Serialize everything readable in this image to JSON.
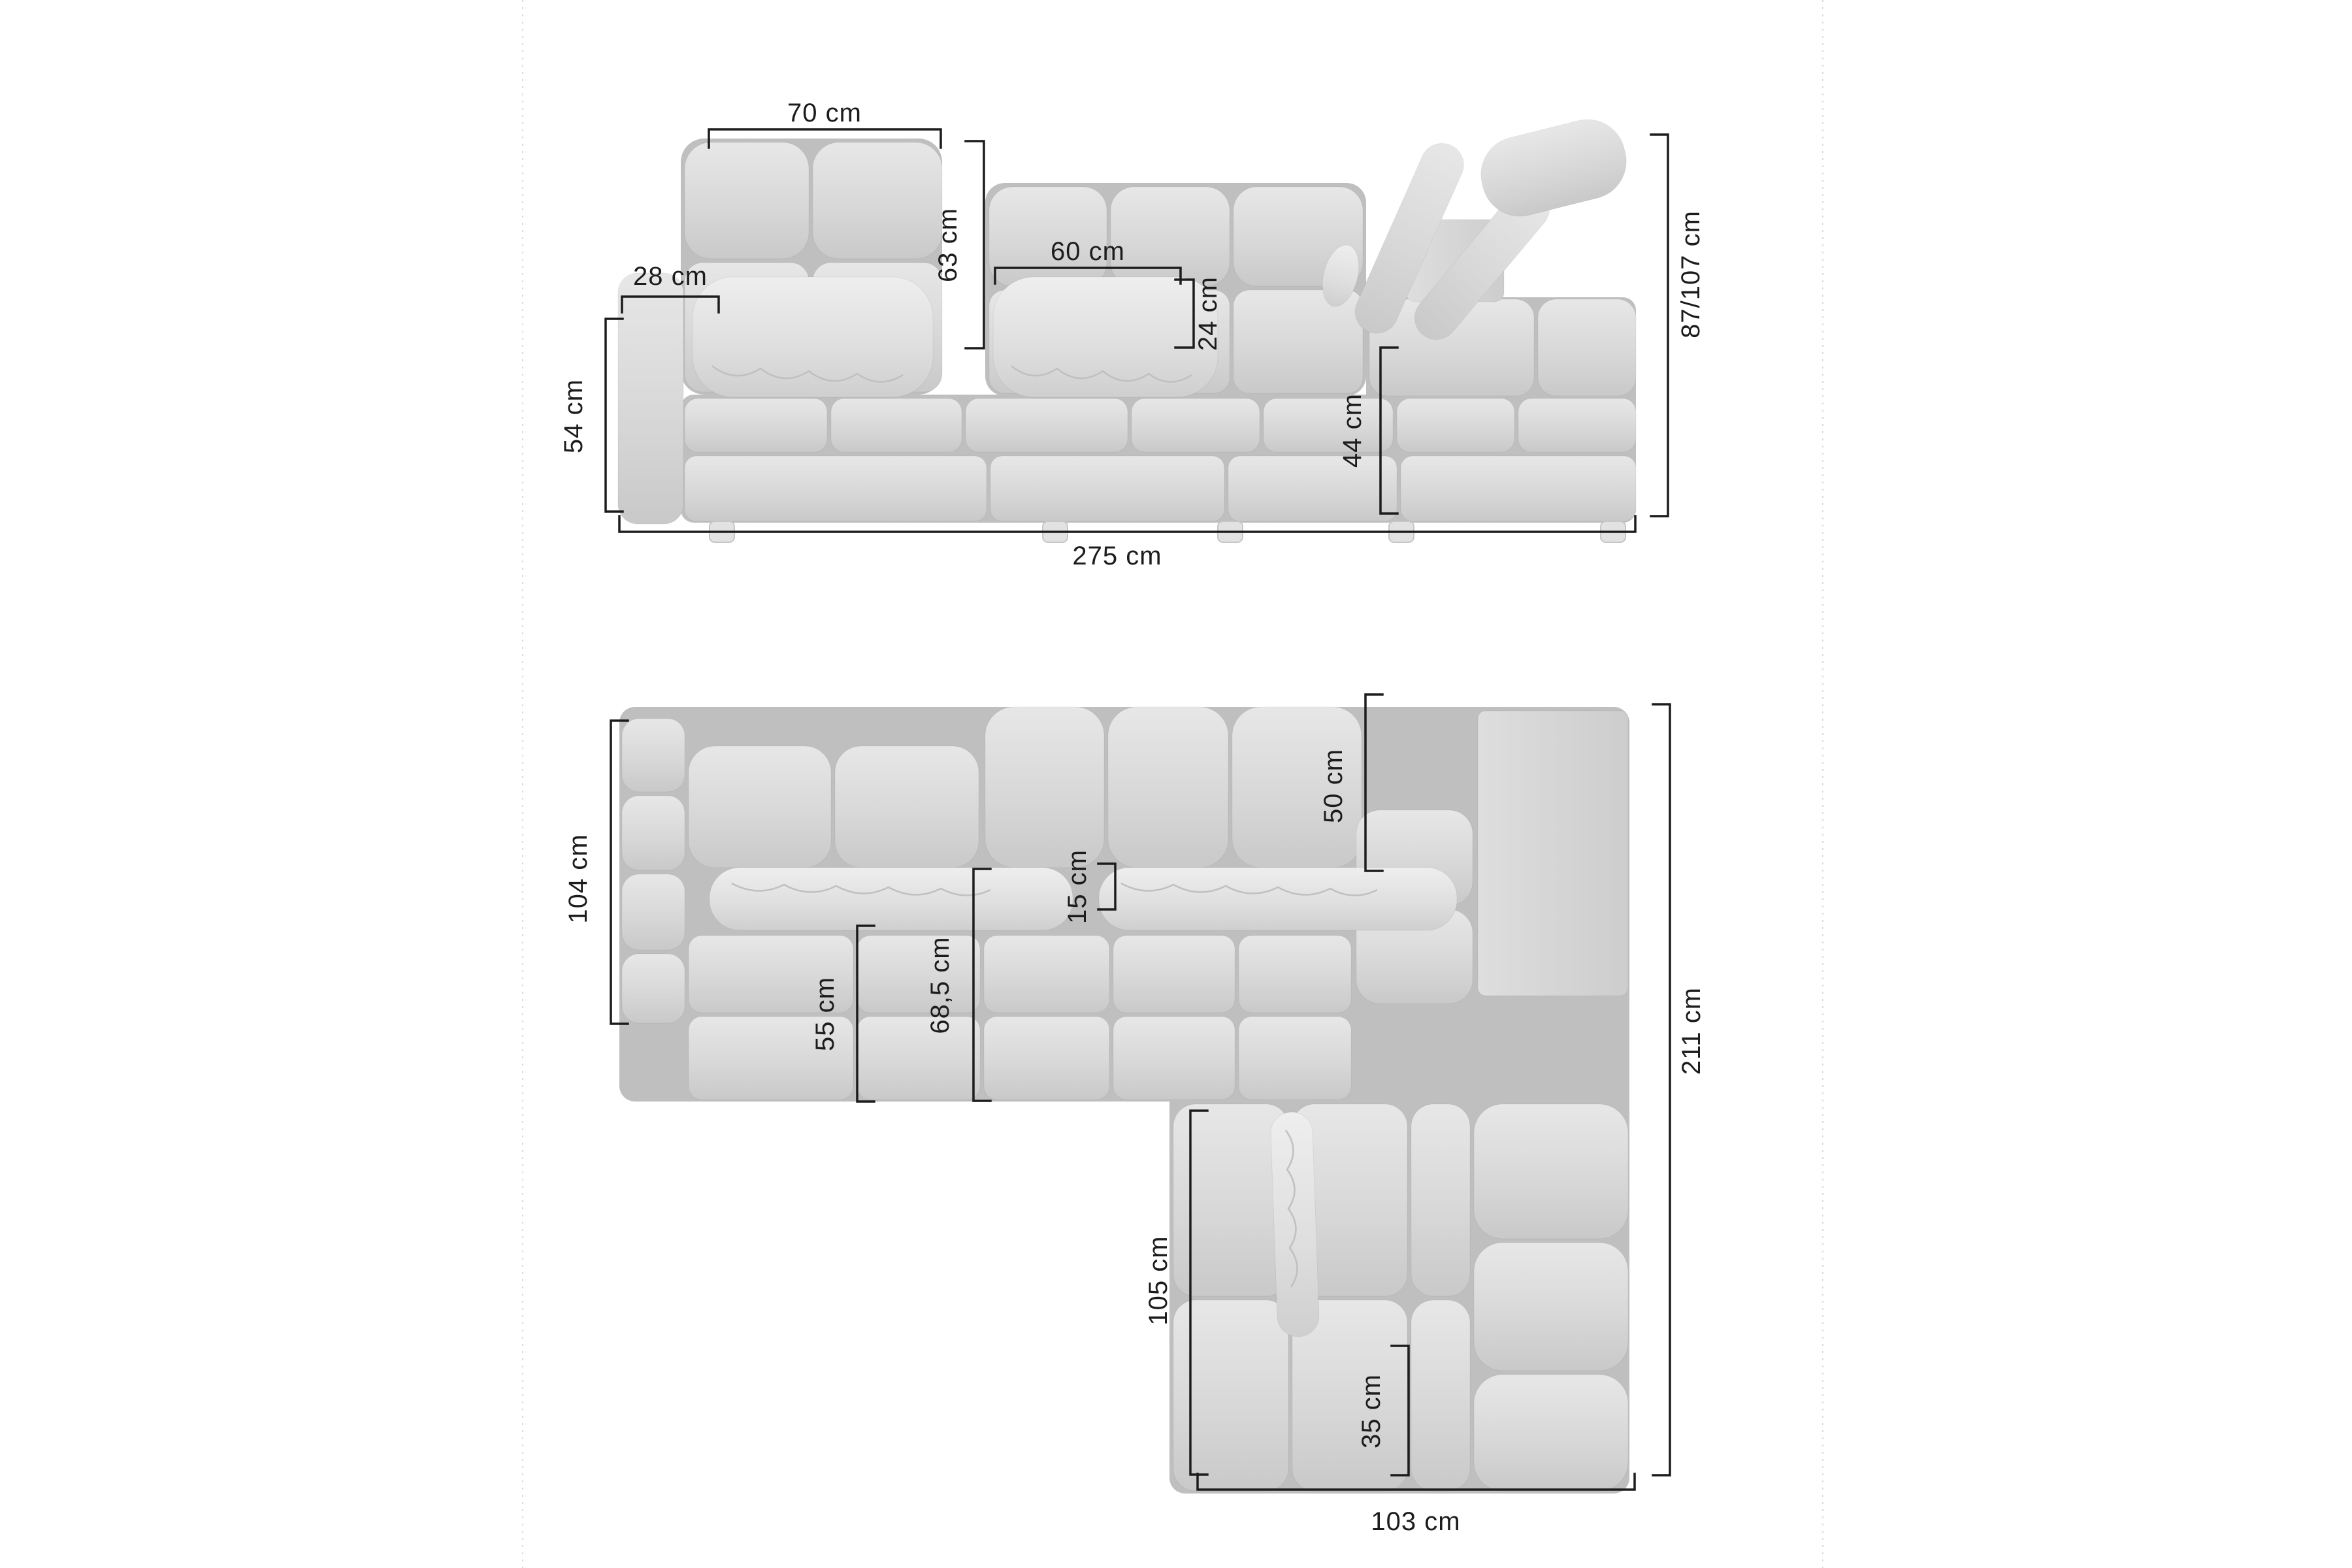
{
  "colors": {
    "background": "#ffffff",
    "dimension_line": "#1c1c1c",
    "label_text": "#1c1c1c",
    "sofa_light": "#e6e6e6",
    "sofa_mid": "#d6d6d6",
    "sofa_shadow": "#bfbfbf",
    "guide_line": "#dcdcdc"
  },
  "front_view": {
    "dim_back_module_width": "70 cm",
    "dim_back_height": "63 cm",
    "dim_armrest_width": "28 cm",
    "dim_pillow_width": "60 cm",
    "dim_pillow_height": "24 cm",
    "dim_armrest_height": "54 cm",
    "dim_seat_height": "44 cm",
    "dim_total_height": "87/107 cm",
    "dim_total_width": "275 cm"
  },
  "top_view": {
    "dim_body_depth": "104 cm",
    "dim_backrest_depth": "50 cm",
    "dim_pillow_depth": "15 cm",
    "dim_seat_depth_with_pillow": "68,5 cm",
    "dim_seat_depth": "55 cm",
    "dim_total_depth": "211 cm",
    "dim_chaise_length": "105 cm",
    "dim_corner_seat_width": "35 cm",
    "dim_chaise_width": "103 cm"
  }
}
